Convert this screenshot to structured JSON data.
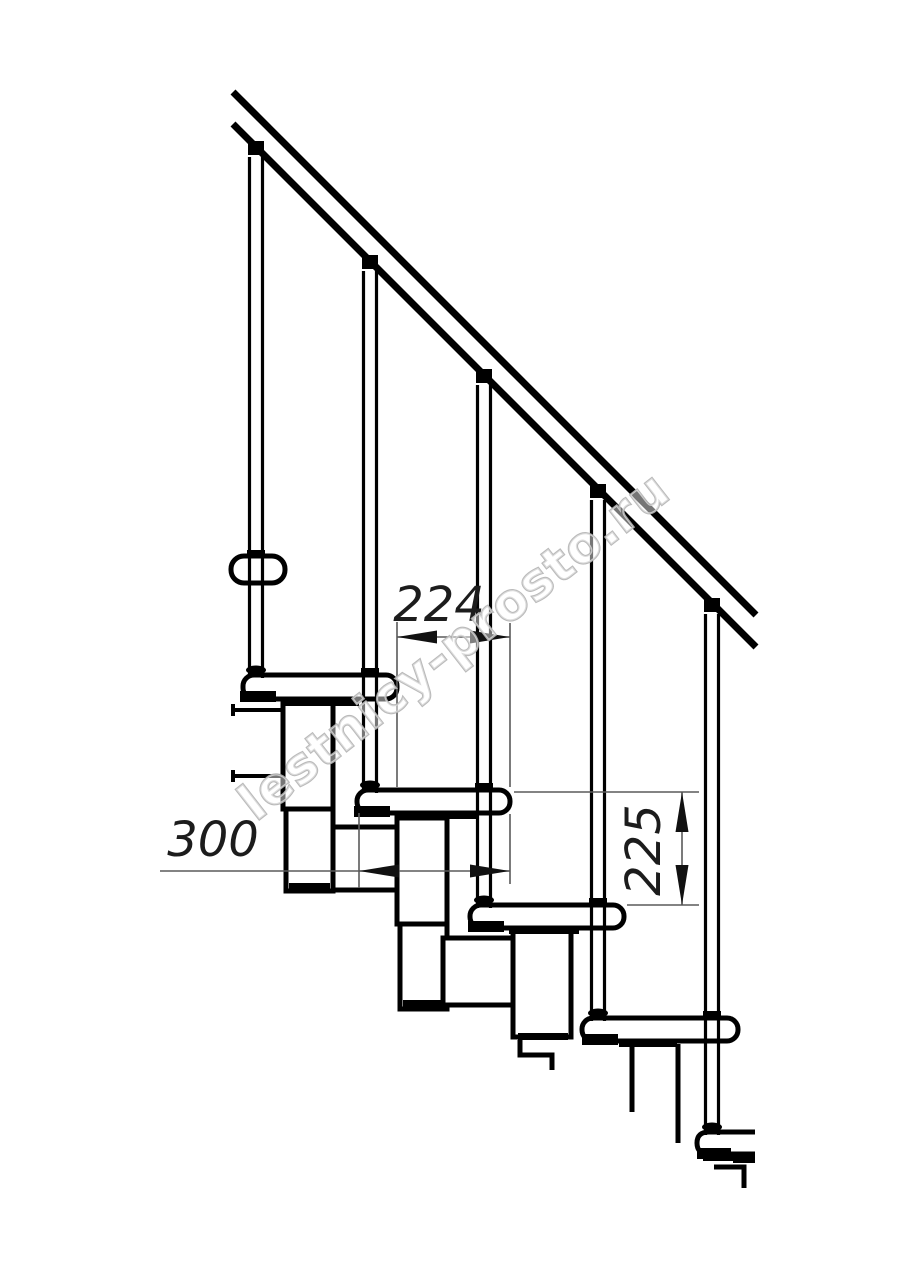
{
  "drawing": {
    "watermark": "lestnicy-prosto.ru",
    "dimensions": [
      {
        "id": "horizontal-step-offset",
        "value": "224"
      },
      {
        "id": "tread-depth",
        "value": "300"
      },
      {
        "id": "step-rise",
        "value": "225"
      }
    ],
    "colors": {
      "line": "#000000",
      "dimension_line": "#5a5a5a",
      "dimension_text": "#1c1c1c",
      "watermark": "#b5b5b5",
      "background": "#ffffff"
    }
  }
}
